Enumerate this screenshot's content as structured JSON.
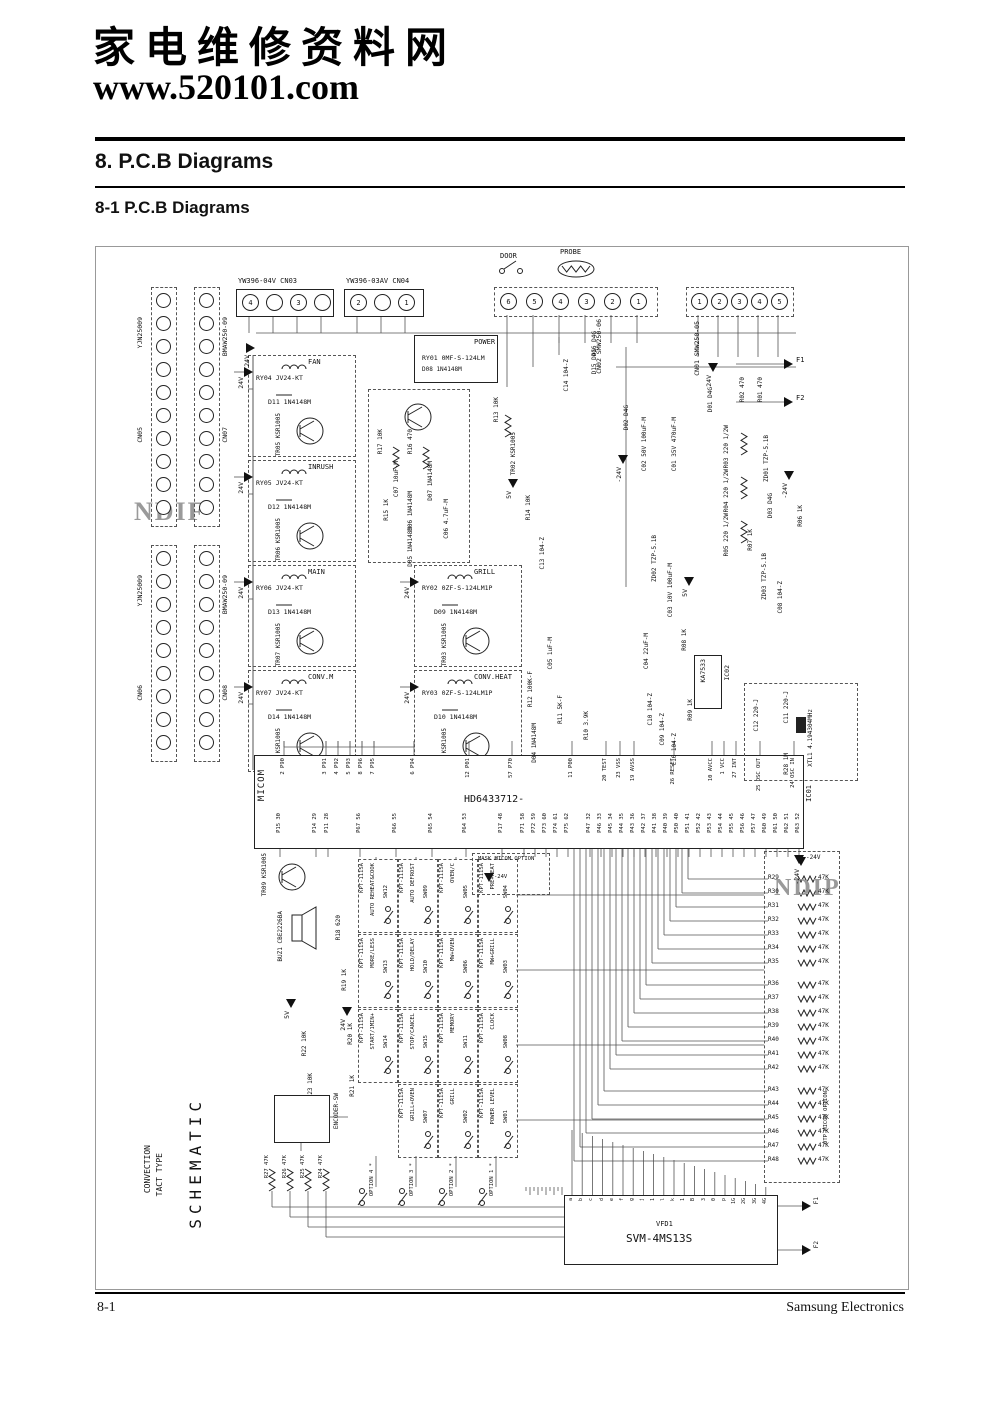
{
  "header": {
    "logo_line1": "家电维修资料网",
    "logo_line2": "www.520101.com",
    "title": "8. P.C.B Diagrams",
    "subtitle": "8-1 P.C.B Diagrams"
  },
  "footer": {
    "page_number": "8-1",
    "company": "Samsung Electronics"
  },
  "colors": {
    "ink": "#111111",
    "watermark": "#9a9a9a"
  },
  "schematic": {
    "watermarks": {
      "left": "NDIF",
      "right": "NDIP"
    },
    "texts": {
      "schematic_label": "SCHEMATIC",
      "type_line1": "CONVECTION",
      "type_line2": "TACT TYPE",
      "mask_option": "MASK MICOM OPTION",
      "mask_option_volt": "-24V",
      "otp_option": "OTP MICOM OPTION",
      "door": "DOOR",
      "probe": "PROBE",
      "encoder": "ENCODER-SW"
    },
    "left_connectors": [
      {
        "part": "YJN25009",
        "id": "CN05",
        "pins": 10
      },
      {
        "part": "BMAW250-09",
        "id": "CN07",
        "pins": 10
      },
      {
        "part": "YJN25009",
        "id": "CN06",
        "pins": 9
      },
      {
        "part": "BMAW250-09",
        "id": "CN08",
        "pins": 9
      }
    ],
    "top_connectors": [
      {
        "part": "YW396-04V",
        "id": "CN03",
        "pins": [
          "4",
          "",
          "3",
          ""
        ]
      },
      {
        "part": "YW396-03AV",
        "id": "CN04",
        "pins": [
          "2",
          "",
          "1"
        ]
      }
    ],
    "cn02": {
      "id": "CN02",
      "part": "SMW250-06",
      "pins": [
        "6",
        "5",
        "4",
        "3",
        "2",
        "1"
      ]
    },
    "cn01": {
      "id": "CN01",
      "part": "SMW250-05",
      "pins": [
        "1",
        "2",
        "3",
        "4",
        "5"
      ]
    },
    "relays": [
      {
        "name": "FAN",
        "ref": "RY04",
        "part": "JV24-KT",
        "diode": "D11 1N4148M",
        "tr": "TR05",
        "tr_part": "KSR1005",
        "volt": "24V"
      },
      {
        "name": "INRUSH",
        "ref": "RY05",
        "part": "JV24-KT",
        "diode": "D12 1N4148M",
        "tr": "TR06",
        "tr_part": "KSR1005",
        "volt": "24V"
      },
      {
        "name": "MAIN",
        "ref": "RY06",
        "part": "JV24-KT",
        "diode": "D13 1N4148M",
        "tr": "TR07",
        "tr_part": "KSR1005",
        "volt": "24V"
      },
      {
        "name": "CONV.M",
        "ref": "RY07",
        "part": "JV24-KT",
        "diode": "D14 1N4148M",
        "tr": "TR08",
        "tr_part": "KSR1005",
        "volt": "24V"
      },
      {
        "name": "GRILL",
        "ref": "RY02",
        "part": "0ZF-S-124LM1P",
        "diode": "D09 1N4148M",
        "tr": "TR03",
        "tr_part": "KSR1005",
        "volt": "24V"
      },
      {
        "name": "CONV.HEAT",
        "ref": "RY03",
        "part": "0ZF-S-124LM1P",
        "diode": "D10 1N4148M",
        "tr": "TR04",
        "tr_part": "KSR1005",
        "volt": "24V"
      },
      {
        "name": "POWER",
        "ref": "RY01",
        "part": "0MF-S-124LM",
        "diode": "D08 1N4148M",
        "tr": "TR01",
        "tr_part": "KSC815Y",
        "volt": ""
      }
    ],
    "micom": {
      "label": "MICOM",
      "part": "HD6433712-",
      "ref": "IC01",
      "top_pins": [
        "2 P90",
        "3 P91",
        "4 P92",
        "5 P93",
        "8 P96",
        "7 P95",
        "6 P94",
        "12 P01",
        "57 P70",
        "11 P00",
        "20 TEST",
        "23 VSS",
        "19 AVSS",
        "26 RESET",
        "10 AVCC",
        "1 VCC",
        "27 INT",
        "25 OSC OUT",
        "24 OSC IN"
      ],
      "bottom_pins": [
        "P15 30",
        "P14 29",
        "P11 28",
        "P67 56",
        "P66 55",
        "P65 54",
        "P64 53",
        "P17 48",
        "P71 58",
        "P72 59",
        "P73 60",
        "P74 61",
        "P75 62",
        "P47 32",
        "P46 33",
        "P45 34",
        "P44 35",
        "P43 36",
        "P42 37",
        "P41 38",
        "P40 39",
        "P50 40",
        "P51 41",
        "P52 42",
        "P53 43",
        "P54 44",
        "P55 45",
        "P56 46",
        "P57 47",
        "P60 49",
        "P61 50",
        "P62 51",
        "P63 52"
      ]
    },
    "ic02": {
      "ref": "IC02",
      "part": "KA7533"
    },
    "xtal": {
      "ref": "XTL1",
      "value": "4.194304MHz"
    },
    "switch_part": "KPT-1115A",
    "switch_rows": [
      [
        {
          "ref": "SW12",
          "name": "AUTO REHEAT&COOK"
        },
        {
          "ref": "SW09",
          "name": "AUTO DEFROST"
        },
        {
          "ref": "SW05",
          "name": "OVEN/C"
        },
        {
          "ref": "SW04",
          "name": "PRE+HEAT"
        }
      ],
      [
        {
          "ref": "SW13",
          "name": "MORE/LESS"
        },
        {
          "ref": "SW10",
          "name": "HOLD/DELAY"
        },
        {
          "ref": "SW06",
          "name": "MW+OVEN"
        },
        {
          "ref": "SW03",
          "name": "MW+GRILL"
        }
      ],
      [
        {
          "ref": "SW14",
          "name": "START/1MIN+"
        },
        {
          "ref": "SW15",
          "name": "STOP/CANCEL"
        },
        {
          "ref": "SW11",
          "name": "MEMORY"
        },
        {
          "ref": "SW08",
          "name": "CLOCK"
        }
      ],
      [
        null,
        {
          "ref": "SW07",
          "name": "GRILL+OVEN"
        },
        {
          "ref": "SW02",
          "name": "GRILL"
        },
        {
          "ref": "SW01",
          "name": "POWER LEVEL"
        }
      ]
    ],
    "option_switches": [
      "OPTION 4 *",
      "OPTION 3 *",
      "OPTION 2 *",
      "OPTION 1 *"
    ],
    "resistor_bank": {
      "volt": "-24V",
      "items": [
        {
          "ref": "R29",
          "value": "47K"
        },
        {
          "ref": "R30",
          "value": "47K"
        },
        {
          "ref": "R31",
          "value": "47K"
        },
        {
          "ref": "R32",
          "value": "47K"
        },
        {
          "ref": "R33",
          "value": "47K"
        },
        {
          "ref": "R34",
          "value": "47K"
        },
        {
          "ref": "R35",
          "value": "47K"
        },
        {
          "ref": "R36",
          "value": "47K"
        },
        {
          "ref": "R37",
          "value": "47K"
        },
        {
          "ref": "R38",
          "value": "47K"
        },
        {
          "ref": "R39",
          "value": "47K"
        },
        {
          "ref": "R40",
          "value": "47K"
        },
        {
          "ref": "R41",
          "value": "47K"
        },
        {
          "ref": "R42",
          "value": "47K"
        },
        {
          "ref": "R43",
          "value": "47K"
        },
        {
          "ref": "R44",
          "value": "47K"
        },
        {
          "ref": "R45",
          "value": "47K"
        },
        {
          "ref": "R46",
          "value": "47K"
        },
        {
          "ref": "R47",
          "value": "47K"
        },
        {
          "ref": "R48",
          "value": "47K"
        }
      ]
    },
    "left_resistors": [
      {
        "ref": "R27",
        "value": "47K"
      },
      {
        "ref": "R26",
        "value": "47K"
      },
      {
        "ref": "R25",
        "value": "47K"
      },
      {
        "ref": "R24",
        "value": "47K"
      }
    ],
    "buzzer": {
      "tr": "TR09",
      "tr_part": "KSR1005",
      "buz_ref": "BUZ1",
      "buz_part": "CBE2226BA"
    },
    "vfd": {
      "ref": "VFD1",
      "part": "SVM-4MS13S",
      "pins": [
        "a",
        "b",
        "c",
        "d",
        "e",
        "f",
        "g",
        "j",
        "1",
        "l",
        "k",
        "1",
        "B",
        "3",
        "0",
        "p",
        "1G",
        "2G",
        "3G",
        "4G"
      ],
      "fuses": [
        "F1",
        "F2"
      ]
    },
    "parts": [
      {
        "ref": "R13",
        "value": "10K"
      },
      {
        "ref": "TR02",
        "value": "KSR1005"
      },
      {
        "ref": "R14",
        "value": "10K"
      },
      {
        "ref": "C13",
        "value": "104-Z"
      },
      {
        "ref": "C14",
        "value": "104-Z"
      },
      {
        "ref": "D16",
        "value": "D4G"
      },
      {
        "ref": "D15",
        "value": "D4G"
      },
      {
        "ref": "D02",
        "value": "D4G"
      },
      {
        "ref": "C02",
        "value": "50V 100uF-M"
      },
      {
        "ref": "C01",
        "value": "35V 470uF-M"
      },
      {
        "ref": "D01",
        "value": "D4G"
      },
      {
        "ref": "R03",
        "value": "220 1/2W"
      },
      {
        "ref": "R04",
        "value": "220 1/2W"
      },
      {
        "ref": "R05",
        "value": "220 1/2W"
      },
      {
        "ref": "ZD02",
        "value": "TZP-5.1B"
      },
      {
        "ref": "C03",
        "value": "10V 100uF-M"
      },
      {
        "ref": "D03",
        "value": "D4G"
      },
      {
        "ref": "R06",
        "value": "1K"
      },
      {
        "ref": "R07",
        "value": "1K"
      },
      {
        "ref": "ZD03",
        "value": "TZP-5.1B"
      },
      {
        "ref": "C08",
        "value": "104-Z"
      },
      {
        "ref": "R01",
        "value": "470"
      },
      {
        "ref": "R02",
        "value": "470"
      },
      {
        "ref": "ZD01",
        "value": "TZP-5.1B"
      },
      {
        "ref": "R17",
        "value": "10K"
      },
      {
        "ref": "R16",
        "value": "470"
      },
      {
        "ref": "C07",
        "value": "10uF-M"
      },
      {
        "ref": "D07",
        "value": "1N4148M"
      },
      {
        "ref": "D06",
        "value": "1N4148M"
      },
      {
        "ref": "R15",
        "value": "1K"
      },
      {
        "ref": "D05",
        "value": "1N4148M"
      },
      {
        "ref": "C06",
        "value": "4.7uF-M"
      },
      {
        "ref": "C05",
        "value": "1uF-M"
      },
      {
        "ref": "R12",
        "value": "100K-F"
      },
      {
        "ref": "R11",
        "value": "5K-F"
      },
      {
        "ref": "D04",
        "value": "1N4148M"
      },
      {
        "ref": "R10",
        "value": "3.9K"
      },
      {
        "ref": "C04",
        "value": "22uF-M"
      },
      {
        "ref": "R08",
        "value": "1K"
      },
      {
        "ref": "R09",
        "value": "1K"
      },
      {
        "ref": "C10",
        "value": "104-Z"
      },
      {
        "ref": "C09",
        "value": "104-Z"
      },
      {
        "ref": "C16",
        "value": "104-Z"
      },
      {
        "ref": "C12",
        "value": "220-J"
      },
      {
        "ref": "C11",
        "value": "220-J"
      },
      {
        "ref": "R28",
        "value": "1M"
      },
      {
        "ref": "R18",
        "value": "620"
      },
      {
        "ref": "R19",
        "value": "1K"
      },
      {
        "ref": "R20",
        "value": "1K"
      },
      {
        "ref": "R21",
        "value": "1K"
      },
      {
        "ref": "R22",
        "value": "10K"
      },
      {
        "ref": "R23",
        "value": "10K"
      }
    ],
    "volt_labels": [
      {
        "text": "24V"
      },
      {
        "text": "-24V"
      },
      {
        "text": "5V"
      },
      {
        "text": "-24V"
      },
      {
        "text": "5V"
      },
      {
        "text": "24V"
      },
      {
        "text": "5V"
      },
      {
        "text": "24V"
      },
      {
        "text": "-24V"
      }
    ],
    "fuse_labels_top": [
      "F1",
      "F2"
    ]
  }
}
